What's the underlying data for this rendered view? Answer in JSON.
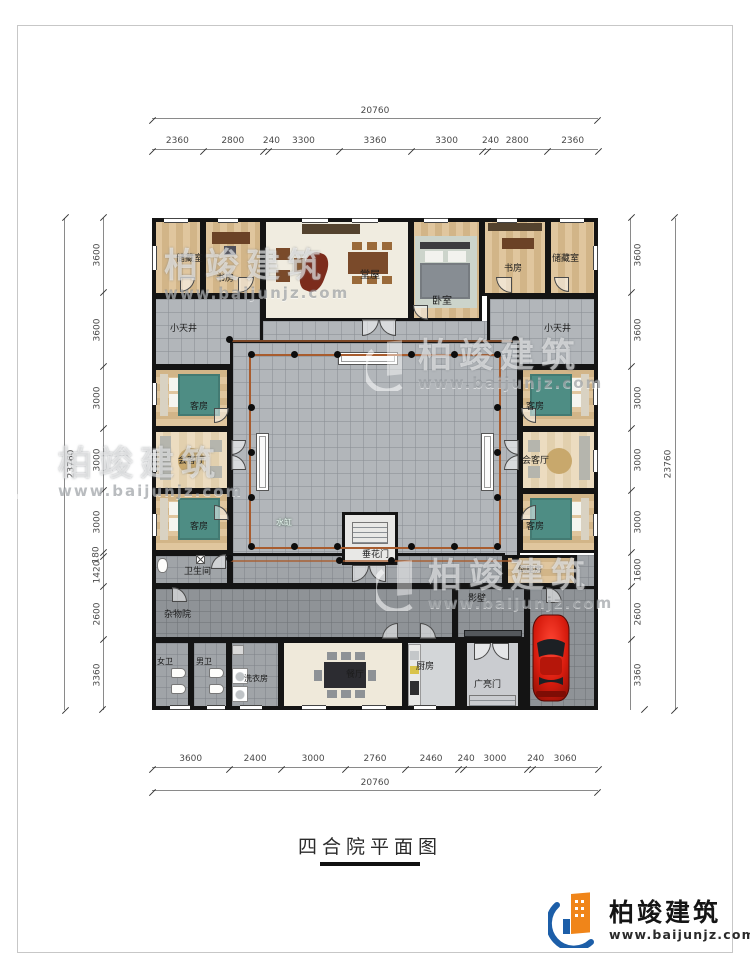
{
  "title": "四合院平面图",
  "brand": {
    "name": "柏竣建筑",
    "site": "www.baijunjz.com"
  },
  "watermark": {
    "name": "柏竣建筑",
    "site": "www.baijunjz.com"
  },
  "dims": {
    "top_total": "20760",
    "top_segments": [
      "2360",
      "2800",
      "240",
      "3300",
      "3360",
      "3300",
      "240",
      "2800",
      "2360"
    ],
    "bottom_total": "20760",
    "bottom_segments": [
      "3600",
      "2400",
      "3000",
      "2760",
      "2460",
      "240",
      "3000",
      "240",
      "3060"
    ],
    "left_total": "23760",
    "left_segments": [
      "3600",
      "3600",
      "3000",
      "3000",
      "3000",
      "180",
      "1420",
      "2600",
      "3360"
    ],
    "right_total": "23760",
    "right_segments": [
      "3600",
      "3600",
      "3000",
      "3000",
      "3000",
      "1600",
      "2600",
      "3360"
    ]
  },
  "rooms": {
    "storage_left": "储藏室",
    "study_left": "书房",
    "hall": "堂屋",
    "bedroom": "卧室",
    "study_right": "书房",
    "storage_right": "储藏室",
    "lightwell_left": "小天井",
    "lightwell_right": "小天井",
    "guest_left_top": "客房",
    "reception_left": "会客厅",
    "guest_left_bottom": "客房",
    "guest_right_top": "客房",
    "reception_right": "会客厅",
    "guest_right_bottom": "客房",
    "water_vat": "水缸",
    "festoon_gate": "垂花门",
    "bathroom": "卫生间",
    "sundry_yard": "杂物院",
    "screen_wall": "影壁",
    "south_room": "倒座房",
    "women_wc": "女卫",
    "men_wc": "男卫",
    "laundry": "洗衣房",
    "dining": "餐厅",
    "kitchen": "厨房",
    "entry_gate": "广亮门"
  },
  "colors": {
    "wall": "#141414",
    "courtyard_gray": "#b2b6ba",
    "grass_green": "#58ad48",
    "wood_tan": "#dcc29a",
    "car_red": "#d81c0e",
    "brand_blue": "#1c5ea8",
    "brand_orange": "#f08519"
  }
}
